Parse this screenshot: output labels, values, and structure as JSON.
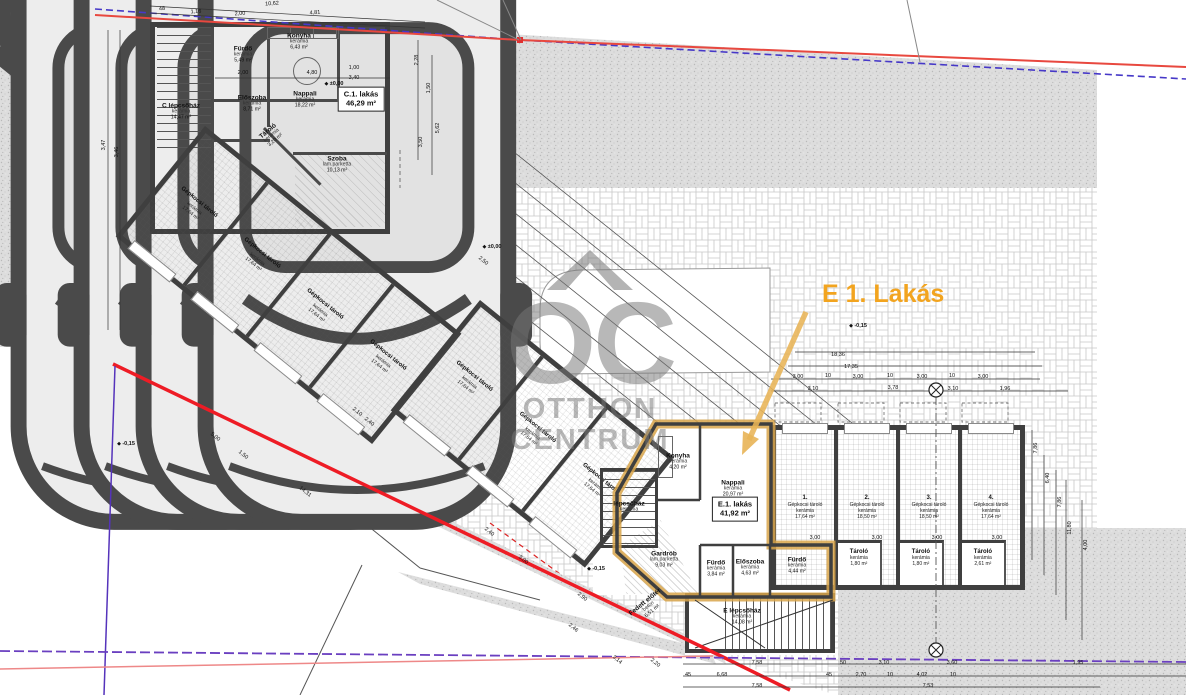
{
  "callout": {
    "label": "E 1. Lakás"
  },
  "watermark": {
    "monogram": "OC",
    "line1": "OTTHON",
    "line2": "CENTRUM"
  },
  "colors": {
    "highlight_orange": "#D8A44A",
    "callout_orange": "#F2A41F",
    "boundary_red": "#E8483F",
    "boundary_blue": "#4638C8",
    "parcel_red": "#EE1C25",
    "parcel_purple": "#6A3FC0",
    "wall": "#3F3F3F",
    "paving_line": "#C8C8C8",
    "road_fill": "#DDDDDD"
  },
  "unit_labels": [
    {
      "title": "C.1. lakás",
      "area": "46,29 m²",
      "x": 361,
      "y": 99
    },
    {
      "title": "E.1. lakás",
      "area": "41,92 m²",
      "x": 735,
      "y": 509
    }
  ],
  "rooms": [
    {
      "label": "C lépcsőház",
      "finish": "kerámia",
      "area": "14,47 m²",
      "x": 181,
      "y": 112
    },
    {
      "label": "Fürdő",
      "finish": "kerámia",
      "area": "5,49 m²",
      "x": 243,
      "y": 55
    },
    {
      "label": "Konyha",
      "finish": "kerámia",
      "area": "6,43 m²",
      "x": 299,
      "y": 42
    },
    {
      "label": "Nappali",
      "finish": "kerámia",
      "area": "18,22 m²",
      "x": 305,
      "y": 100
    },
    {
      "label": "Előszoba",
      "finish": "kerámia",
      "area": "8,71 m²",
      "x": 252,
      "y": 104
    },
    {
      "label": "Tároló",
      "finish": "kerámia",
      "area": "3,20 m²",
      "x": 272,
      "y": 136,
      "rot": -40
    },
    {
      "label": "Szoba",
      "finish": "lam.parketta",
      "area": "10,13 m²",
      "x": 337,
      "y": 165
    },
    {
      "label": "Konyha",
      "finish": "kerámia",
      "area": "4,20 m²",
      "x": 678,
      "y": 462
    },
    {
      "label": "Nappali",
      "finish": "kerámia",
      "area": "20,97 m²",
      "x": 733,
      "y": 489
    },
    {
      "label": "Gardrób",
      "finish": "lam.parketta",
      "area": "9,03 m²",
      "x": 664,
      "y": 560
    },
    {
      "label": "Fürdő",
      "finish": "kerámia",
      "area": "3,84 m²",
      "x": 716,
      "y": 569
    },
    {
      "label": "Előszoba",
      "finish": "kerámia",
      "area": "4,63 m²",
      "x": 750,
      "y": 568
    },
    {
      "label": "Fürdő",
      "finish": "kerámia",
      "area": "4,44 m²",
      "x": 797,
      "y": 566
    },
    {
      "label": "lépcsőház",
      "finish": "kerámia",
      "area": "",
      "x": 629,
      "y": 507
    },
    {
      "label": "E lépcsőház",
      "finish": "kerámia",
      "area": "14,08 m²",
      "x": 742,
      "y": 617
    },
    {
      "label": "Fedett előtér",
      "finish": "beton",
      "area": "6,51 m²",
      "x": 649,
      "y": 607,
      "rot": -39
    }
  ],
  "garage_bays_right": [
    {
      "no": "1.",
      "name": "Gépkocsi tároló",
      "finish": "kerámia",
      "area": "17,64 m²",
      "store": null
    },
    {
      "no": "2.",
      "name": "Gépkocsi tároló",
      "finish": "kerámia",
      "area": "18,50 m²",
      "store": {
        "name": "Tároló",
        "finish": "kerámia",
        "area": "1,80 m²"
      }
    },
    {
      "no": "3.",
      "name": "Gépkocsi tároló",
      "finish": "kerámia",
      "area": "18,50 m²",
      "store": {
        "name": "Tároló",
        "finish": "kerámia",
        "area": "1,80 m²"
      }
    },
    {
      "no": "4.",
      "name": "Gépkocsi tároló",
      "finish": "kerámia",
      "area": "17,64 m²",
      "store": {
        "name": "Tároló",
        "finish": "kerámia",
        "area": "2,61 m²"
      }
    }
  ],
  "garage_bays_left": [
    {
      "name": "Gépkocsi tároló",
      "finish": "kerámia",
      "area": "17,64 m²"
    },
    {
      "name": "Gépkocsi tároló",
      "finish": "kerámia",
      "area": "17,64 m²"
    },
    {
      "name": "Gépkocsi tároló",
      "finish": "kerámia",
      "area": "17,64 m²"
    },
    {
      "name": "Gépkocsi tároló",
      "finish": "kerámia",
      "area": "17,64 m²"
    }
  ],
  "garage_bays_mid": [
    {
      "name": "Gépkocsi tároló",
      "finish": "kerámia",
      "area": "17,64 m²"
    },
    {
      "name": "Gépkocsi tároló",
      "finish": "kerámia",
      "area": "17,64 m²"
    },
    {
      "name": "Gépkocsi tároló",
      "finish": "kerámia",
      "area": "17,64 m²"
    }
  ],
  "elevations": [
    {
      "t": "±0,00",
      "x": 334,
      "y": 84
    },
    {
      "t": "±0,00",
      "x": 492,
      "y": 247
    },
    {
      "t": "-0,15",
      "x": 858,
      "y": 326
    },
    {
      "t": "-0,15",
      "x": 596,
      "y": 569
    },
    {
      "t": "-0,15",
      "x": 126,
      "y": 444
    }
  ],
  "dimensions": [
    {
      "t": "10,62",
      "x": 272,
      "y": 4,
      "r": -4
    },
    {
      "t": "4,81",
      "x": 315,
      "y": 13,
      "r": -4
    },
    {
      "t": "2,00",
      "x": 240,
      "y": 14,
      "r": -4
    },
    {
      "t": "1,16",
      "x": 196,
      "y": 12,
      "r": -4
    },
    {
      "t": "48",
      "x": 162,
      "y": 9,
      "r": -4
    },
    {
      "t": "2,00",
      "x": 243,
      "y": 73,
      "r": 0
    },
    {
      "t": "4,80",
      "x": 312,
      "y": 73,
      "r": 0
    },
    {
      "t": "1,00",
      "x": 354,
      "y": 68,
      "r": 0
    },
    {
      "t": "3,40",
      "x": 354,
      "y": 78,
      "r": 0
    },
    {
      "t": "3,47",
      "x": 104,
      "y": 145,
      "r": -90
    },
    {
      "t": "3,46",
      "x": 117,
      "y": 152,
      "r": -90
    },
    {
      "t": "2,28",
      "x": 417,
      "y": 60,
      "r": -90
    },
    {
      "t": "1,50",
      "x": 429,
      "y": 88,
      "r": -90
    },
    {
      "t": "5,62",
      "x": 438,
      "y": 128,
      "r": -90
    },
    {
      "t": "3,50",
      "x": 421,
      "y": 142,
      "r": -90
    },
    {
      "t": "18,36",
      "x": 838,
      "y": 355,
      "r": 0
    },
    {
      "t": "17,35",
      "x": 851,
      "y": 367,
      "r": 0
    },
    {
      "t": "3,00",
      "x": 798,
      "y": 377,
      "r": 0
    },
    {
      "t": "10",
      "x": 828,
      "y": 376,
      "r": 0
    },
    {
      "t": "3,00",
      "x": 858,
      "y": 377,
      "r": 0
    },
    {
      "t": "10",
      "x": 890,
      "y": 376,
      "r": 0
    },
    {
      "t": "3,00",
      "x": 922,
      "y": 377,
      "r": 0
    },
    {
      "t": "10",
      "x": 952,
      "y": 376,
      "r": 0
    },
    {
      "t": "3,00",
      "x": 983,
      "y": 377,
      "r": 0
    },
    {
      "t": "3,10",
      "x": 813,
      "y": 389,
      "r": 0
    },
    {
      "t": "3,78",
      "x": 893,
      "y": 388,
      "r": 0
    },
    {
      "t": "3,10",
      "x": 953,
      "y": 389,
      "r": 0
    },
    {
      "t": "1,96",
      "x": 1005,
      "y": 389,
      "r": 0
    },
    {
      "t": "7,86",
      "x": 1036,
      "y": 448,
      "r": -90
    },
    {
      "t": "6,40",
      "x": 1048,
      "y": 478,
      "r": -90
    },
    {
      "t": "7,86",
      "x": 1060,
      "y": 502,
      "r": -90
    },
    {
      "t": "11,80",
      "x": 1070,
      "y": 528,
      "r": -90
    },
    {
      "t": "4,00",
      "x": 1086,
      "y": 545,
      "r": -90
    },
    {
      "t": "7,58",
      "x": 757,
      "y": 663,
      "r": 0
    },
    {
      "t": "50",
      "x": 843,
      "y": 663,
      "r": 0
    },
    {
      "t": "3,10",
      "x": 884,
      "y": 663,
      "r": 0
    },
    {
      "t": "3,60",
      "x": 952,
      "y": 663,
      "r": 0
    },
    {
      "t": "1,95",
      "x": 1078,
      "y": 663,
      "r": 0
    },
    {
      "t": "45",
      "x": 688,
      "y": 675,
      "r": 0
    },
    {
      "t": "6,68",
      "x": 722,
      "y": 675,
      "r": 0
    },
    {
      "t": "45",
      "x": 829,
      "y": 675,
      "r": 0
    },
    {
      "t": "2,70",
      "x": 861,
      "y": 675,
      "r": 0
    },
    {
      "t": "10",
      "x": 890,
      "y": 675,
      "r": 0
    },
    {
      "t": "4,02",
      "x": 922,
      "y": 675,
      "r": 0
    },
    {
      "t": "10",
      "x": 953,
      "y": 675,
      "r": 0
    },
    {
      "t": "7,58",
      "x": 757,
      "y": 686,
      "r": 0
    },
    {
      "t": "7,53",
      "x": 928,
      "y": 686,
      "r": 0
    },
    {
      "t": "2,50",
      "x": 483,
      "y": 261,
      "r": 39
    },
    {
      "t": "5,00",
      "x": 215,
      "y": 437,
      "r": 39
    },
    {
      "t": "1,50",
      "x": 243,
      "y": 455,
      "r": 39
    },
    {
      "t": "14,31",
      "x": 305,
      "y": 492,
      "r": 39
    },
    {
      "t": "2,90",
      "x": 582,
      "y": 597,
      "r": 39
    },
    {
      "t": "2,46",
      "x": 573,
      "y": 628,
      "r": 39
    },
    {
      "t": "3,14",
      "x": 617,
      "y": 660,
      "r": 39
    },
    {
      "t": "2,20",
      "x": 655,
      "y": 663,
      "r": 39
    },
    {
      "t": "3,00",
      "x": 523,
      "y": 560,
      "r": 39
    },
    {
      "t": "2,40",
      "x": 489,
      "y": 532,
      "r": 39
    },
    {
      "t": "2,10",
      "x": 357,
      "y": 412,
      "r": 39
    },
    {
      "t": "2,40",
      "x": 369,
      "y": 422,
      "r": 39
    },
    {
      "t": "3,00",
      "x": 815,
      "y": 538,
      "r": 0
    },
    {
      "t": "3,00",
      "x": 877,
      "y": 538,
      "r": 0
    },
    {
      "t": "3,00",
      "x": 937,
      "y": 538,
      "r": 0
    },
    {
      "t": "3,00",
      "x": 997,
      "y": 538,
      "r": 0
    }
  ]
}
